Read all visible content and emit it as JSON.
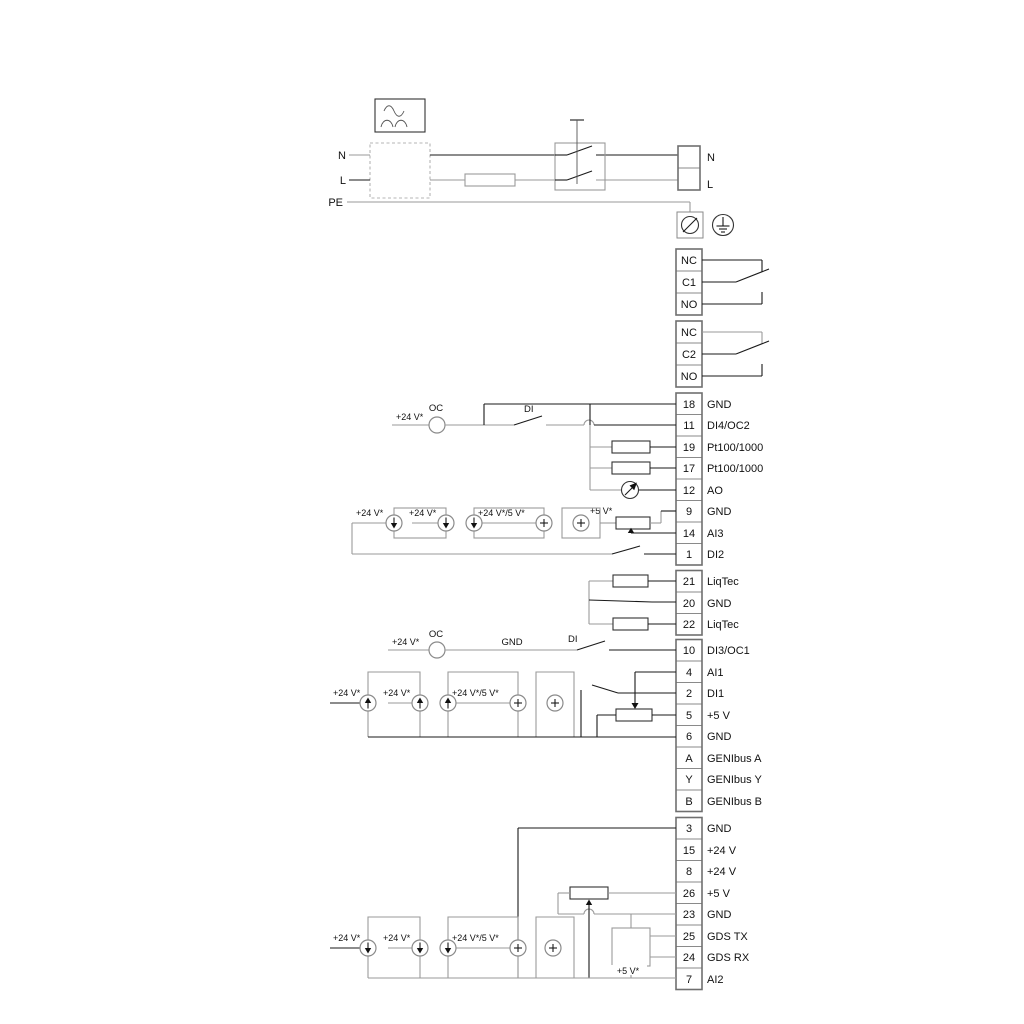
{
  "diagram_title": "pump-controller-wiring-diagram",
  "power": {
    "left": {
      "n": "N",
      "l": "L",
      "pe": "PE"
    },
    "right": {
      "n": "N",
      "l": "L"
    }
  },
  "relays": [
    {
      "nc": "NC",
      "com": "C1",
      "no": "NO"
    },
    {
      "nc": "NC",
      "com": "C2",
      "no": "NO"
    }
  ],
  "groups": [
    {
      "rows": [
        {
          "id": "18",
          "label": "GND"
        },
        {
          "id": "11",
          "label": "DI4/OC2"
        },
        {
          "id": "19",
          "label": "Pt100/1000"
        },
        {
          "id": "17",
          "label": "Pt100/1000"
        },
        {
          "id": "12",
          "label": "AO"
        },
        {
          "id": "9",
          "label": "GND"
        },
        {
          "id": "14",
          "label": "AI3"
        },
        {
          "id": "1",
          "label": "DI2"
        }
      ]
    },
    {
      "rows": [
        {
          "id": "21",
          "label": "LiqTec"
        },
        {
          "id": "20",
          "label": "GND"
        },
        {
          "id": "22",
          "label": "LiqTec"
        }
      ]
    },
    {
      "rows": [
        {
          "id": "10",
          "label": "DI3/OC1"
        },
        {
          "id": "4",
          "label": "AI1"
        },
        {
          "id": "2",
          "label": "DI1"
        },
        {
          "id": "5",
          "label": "+5 V"
        },
        {
          "id": "6",
          "label": "GND"
        },
        {
          "id": "A",
          "label": "GENIbus A"
        },
        {
          "id": "Y",
          "label": "GENIbus Y"
        },
        {
          "id": "B",
          "label": "GENIbus B"
        }
      ]
    },
    {
      "rows": [
        {
          "id": "3",
          "label": "GND"
        },
        {
          "id": "15",
          "label": "+24 V"
        },
        {
          "id": "8",
          "label": "+24 V"
        },
        {
          "id": "26",
          "label": "+5 V"
        },
        {
          "id": "23",
          "label": "GND"
        },
        {
          "id": "25",
          "label": "GDS TX"
        },
        {
          "id": "24",
          "label": "GDS RX"
        },
        {
          "id": "7",
          "label": "AI2"
        }
      ]
    }
  ],
  "labels": {
    "di4": {
      "v24": "+24 V*",
      "oc": "OC",
      "di": "DI"
    },
    "di3": {
      "v24": "+24 V*",
      "oc": "OC",
      "di": "DI",
      "gnd": "GND"
    },
    "ai3": {
      "v24a": "+24 V*",
      "v24b": "+24 V*",
      "v24_5": "+24 V*/5 V*",
      "v5": "+5 V*"
    },
    "ai1": {
      "v24a": "+24 V*",
      "v24b": "+24 V*",
      "v24_5": "+24 V*/5 V*"
    },
    "ai2": {
      "v24a": "+24 V*",
      "v24b": "+24 V*",
      "v24_5": "+24 V*/5 V*",
      "v5": "+5 V*"
    }
  },
  "colors": {
    "wire_gray": "#9a9a9a",
    "wire_black": "#1a1a1a",
    "component": "#333333"
  }
}
